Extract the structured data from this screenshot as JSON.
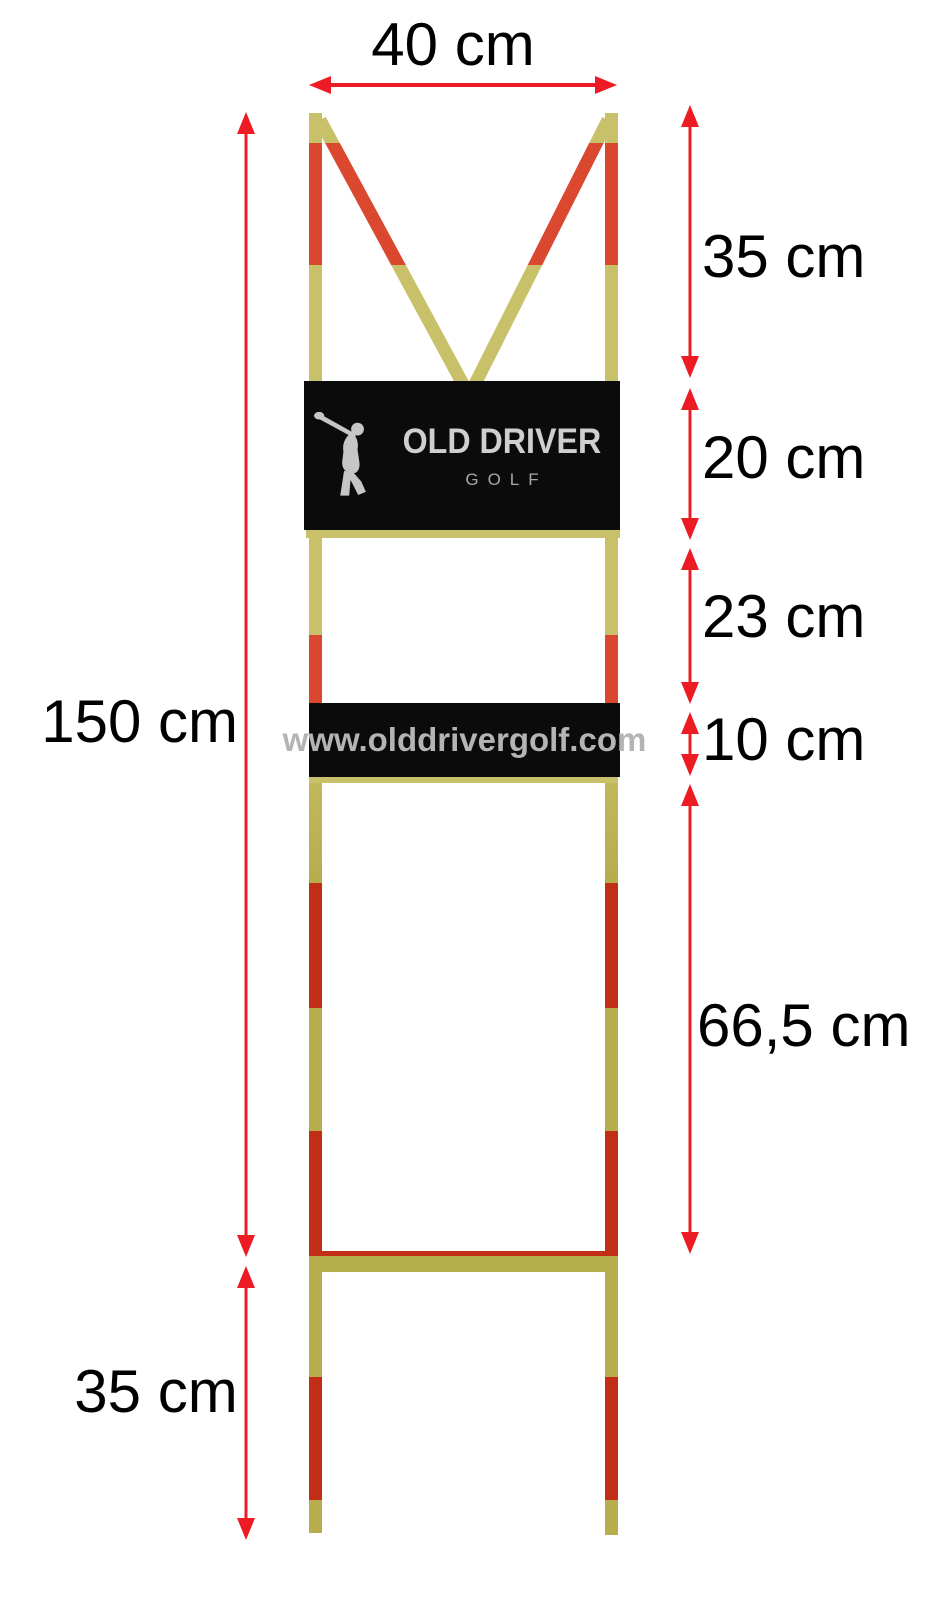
{
  "colors": {
    "page_bg": "#ffffff",
    "label_color": "#000000",
    "dimension_red": "#ed1c24",
    "pole_khaki_light": "#c9c06a",
    "pole_red_light": "#d9482f",
    "pole_khaki_dark": "#b6ad4d",
    "pole_red_dark": "#c22d18",
    "banner_bg": "#0b0b0b",
    "brand_text": "#cfcfcf",
    "brand_sub_text": "#a8a8a8",
    "url_text": "#b4b4b4"
  },
  "brand_banner": {
    "title": "OLD DRIVER",
    "subtitle": "GOLF",
    "icon": "golfer-swing-icon"
  },
  "url_banner": {
    "text": "www.olddrivergolf.com"
  },
  "dimensions": [
    {
      "id": "top-width",
      "label": "40 cm",
      "value_cm": 40,
      "orientation": "h",
      "y": 85,
      "x1": 309,
      "x2": 617,
      "label_x": 453,
      "label_y": 45,
      "align": "center"
    },
    {
      "id": "total-height",
      "label": "150 cm",
      "value_cm": 150,
      "orientation": "v",
      "x": 246,
      "y1": 112,
      "y2": 1257,
      "label_x": 238,
      "label_y": 722,
      "align": "right"
    },
    {
      "id": "ground-stake",
      "label": "35 cm",
      "value_cm": 35,
      "orientation": "v",
      "x": 246,
      "y1": 1266,
      "y2": 1540,
      "label_x": 156,
      "label_y": 1392,
      "align": "center"
    },
    {
      "id": "top-v-section",
      "label": "35 cm",
      "value_cm": 35,
      "orientation": "v",
      "x": 690,
      "y1": 105,
      "y2": 378,
      "label_x": 702,
      "label_y": 257,
      "align": "left"
    },
    {
      "id": "banner-section",
      "label": "20 cm",
      "value_cm": 20,
      "orientation": "v",
      "x": 690,
      "y1": 388,
      "y2": 540,
      "label_x": 702,
      "label_y": 458,
      "align": "left"
    },
    {
      "id": "open-section",
      "label": "23 cm",
      "value_cm": 23,
      "orientation": "v",
      "x": 690,
      "y1": 548,
      "y2": 704,
      "label_x": 702,
      "label_y": 617,
      "align": "left"
    },
    {
      "id": "url-section",
      "label": "10 cm",
      "value_cm": 10,
      "orientation": "v",
      "x": 690,
      "y1": 712,
      "y2": 776,
      "label_x": 702,
      "label_y": 740,
      "align": "left"
    },
    {
      "id": "lower-section",
      "label": "66,5 cm",
      "value_cm": 66.5,
      "orientation": "v",
      "x": 690,
      "y1": 784,
      "y2": 1254,
      "label_x": 697,
      "label_y": 1026,
      "align": "left"
    }
  ]
}
